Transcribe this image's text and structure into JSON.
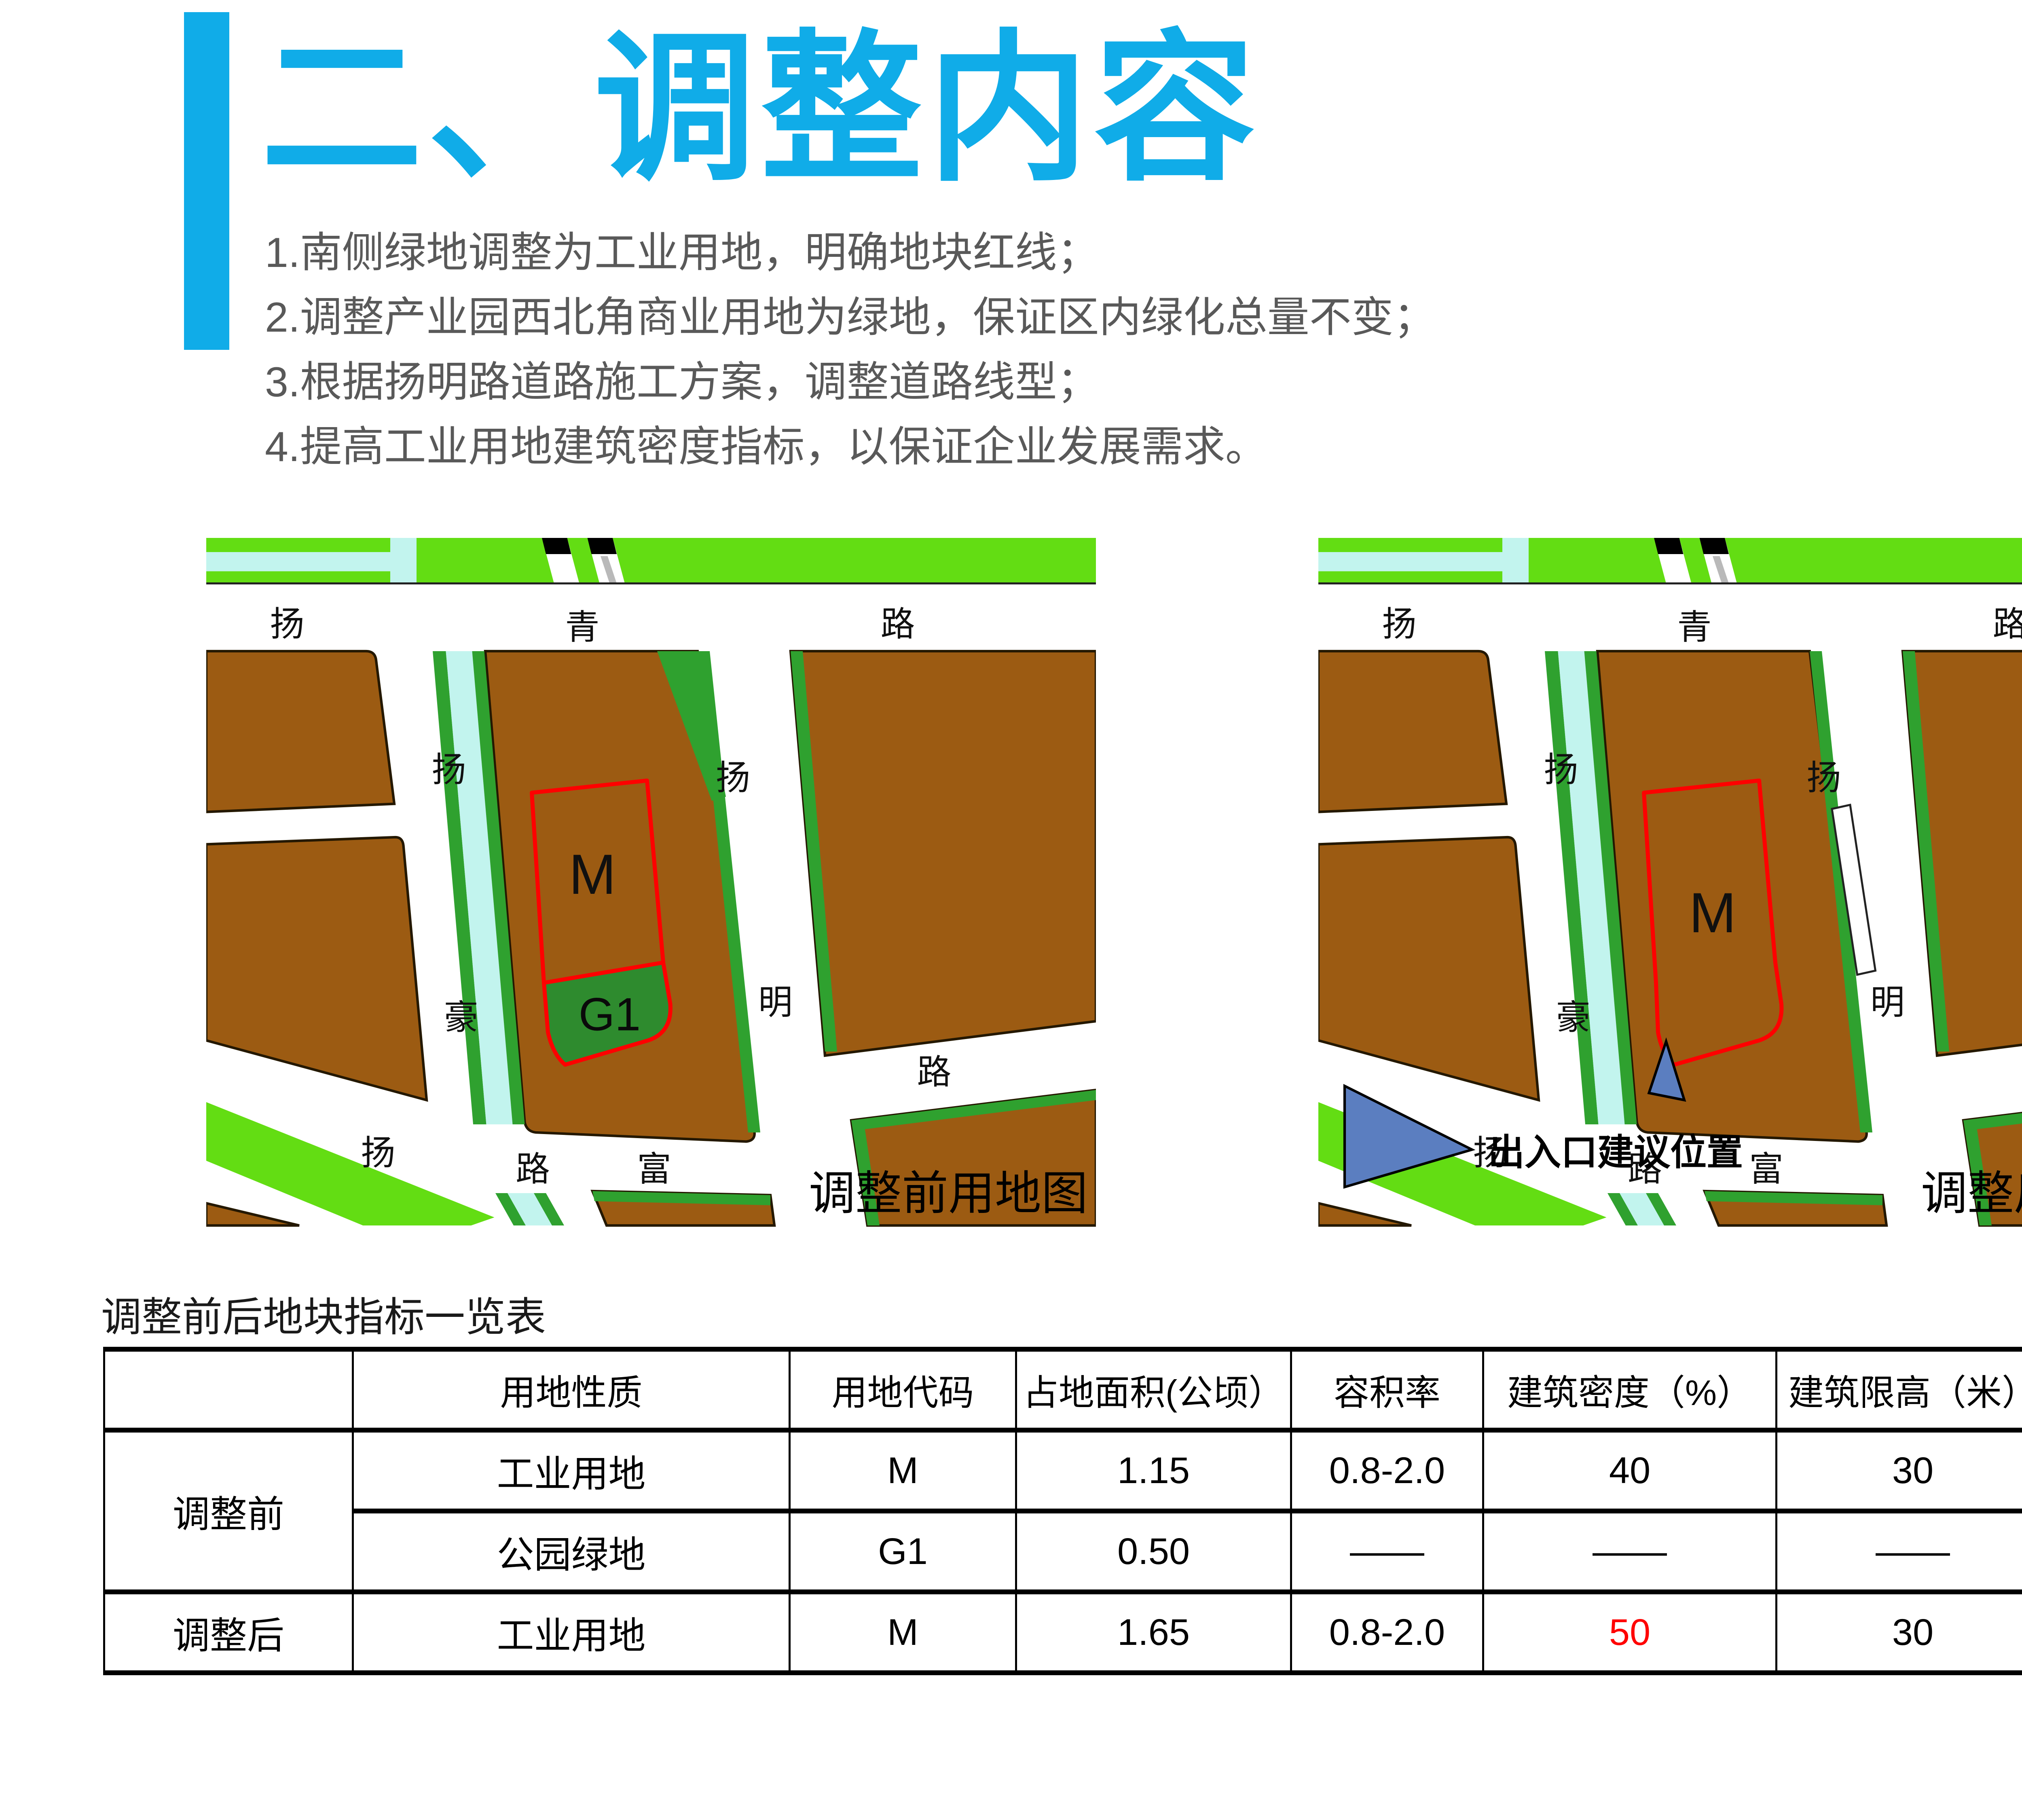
{
  "page": {
    "number": "49"
  },
  "header": {
    "title": "二、调整内容"
  },
  "points": [
    "1.南侧绿地调整为工业用地，明确地块红线；",
    "2.调整产业园西北角商业用地为绿地，保证区内绿化总量不变；",
    "3.根据扬明路道路施工方案，调整道路线型；",
    "4.提高工业用地建筑密度指标，以保证企业发展需求。"
  ],
  "maps": {
    "before": {
      "caption": "调整前用地图",
      "parcel_m": "M",
      "parcel_g1": "G1",
      "roads": {
        "top1": "扬",
        "top2": "青",
        "top3": "路",
        "left1": "扬",
        "left2": "豪",
        "left3": "路",
        "mid1": "扬",
        "mid2": "明",
        "right1": "路",
        "bottom_fu": "富",
        "bottom_yang": "扬"
      }
    },
    "after": {
      "caption": "调整后用地图",
      "parcel_m": "M",
      "legend_label": "出入口建议位置",
      "roads": {
        "top1": "扬",
        "top2": "青",
        "top3": "路",
        "left1": "扬",
        "left2": "豪",
        "left3": "路",
        "mid1": "扬",
        "mid2": "明",
        "right1": "路",
        "bottom_fu": "富",
        "bottom_yang": "扬"
      }
    }
  },
  "table": {
    "title": "调整前后地块指标一览表",
    "columns": [
      "",
      "用地性质",
      "用地代码",
      "占地面积(公顷）",
      "容积率",
      "建筑密度（%）",
      "建筑限高（米）",
      "绿化率（%）"
    ],
    "rows": [
      {
        "group": "调整前",
        "cells": [
          "工业用地",
          "M",
          "1.15",
          "0.8-2.0",
          "40",
          "30",
          "25"
        ]
      },
      {
        "cells": [
          "公园绿地",
          "G1",
          "0.50",
          "——",
          "——",
          "——",
          "——"
        ]
      },
      {
        "group": "调整后",
        "cells": [
          "工业用地",
          "M",
          "1.65",
          "0.8-2.0",
          "50",
          "30",
          "25"
        ]
      }
    ]
  },
  "colors": {
    "accent": "#10ACE8",
    "body_text": "#595959",
    "map_brown": "#9C5B12",
    "map_grass": "#63DD13",
    "map_canal": "#C2F4EE",
    "map_strip": "#2FA12F",
    "map_park": "#2E8B2E",
    "parcel_outline": "#FF0000",
    "marker_blue": "#5B7EC0",
    "highlight_red": "#FF0000",
    "page_number_gray": "#8C8C8C",
    "text_black": "#1A1A1A"
  }
}
